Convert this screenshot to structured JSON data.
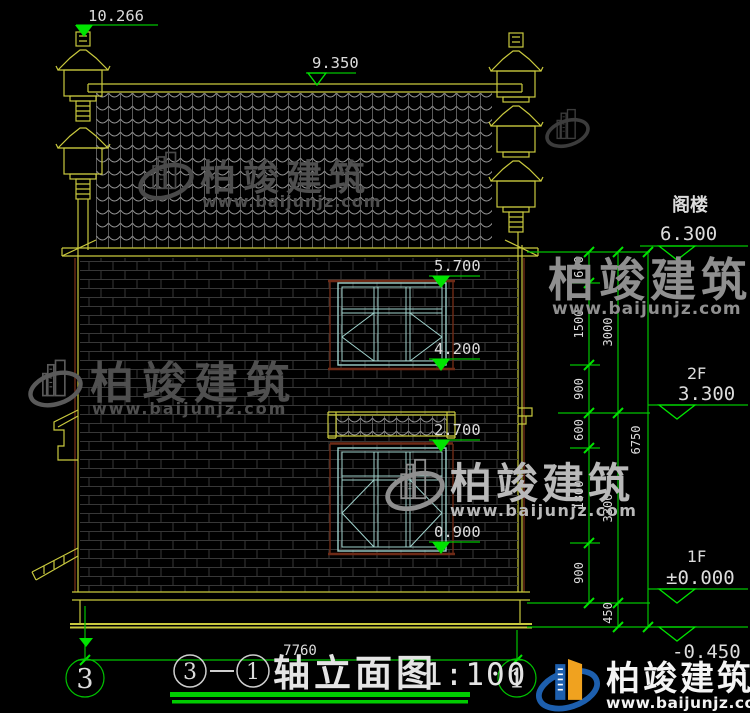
{
  "colors": {
    "bg": "#000000",
    "green": "#00c300",
    "green-bright": "#00e400",
    "underline": "#00cc00",
    "yellow": "#c9c93e",
    "tile": "#9a9a9a",
    "tile-line": "#707070",
    "brick": "#373737",
    "cyan": "#9fd2cc",
    "maroon": "#6e2a16",
    "text": "#dcdcdc",
    "wm-dark": "#4f4f4f",
    "wm-mid": "#8f8f8f",
    "wm-light": "#b9b9b9",
    "logo-blue": "#1d5fae",
    "logo-orange": "#f0a21f"
  },
  "elevations": {
    "finial_top": "10.266",
    "ridge": "9.350",
    "win2_top": "5.700",
    "win2_sill": "4.200",
    "canopy": "2.700",
    "win1_sill": "0.900",
    "attic": {
      "label": "阁楼",
      "value": "6.300"
    },
    "f2": {
      "label": "2F",
      "value": "3.300"
    },
    "f1": {
      "label": "1F",
      "value": "±0.000"
    },
    "ground": {
      "value": "-0.450"
    }
  },
  "dims": {
    "right_inner": [
      "600",
      "1500",
      "900",
      "600",
      "1800",
      "900"
    ],
    "right_mid": [
      "3000",
      "3300",
      "450"
    ],
    "right_total": [
      "6750"
    ],
    "bottom_width": "7760"
  },
  "axis": {
    "left": "3",
    "right": "1"
  },
  "title": {
    "from": "3",
    "to": "1",
    "name": "轴立面图",
    "scale": "1:100"
  },
  "watermark": {
    "brand": "柏竣建筑",
    "url": "www.baijunjz.com"
  },
  "logo": {
    "brand": "柏竣建筑",
    "url": "www.baijunjz.com"
  }
}
